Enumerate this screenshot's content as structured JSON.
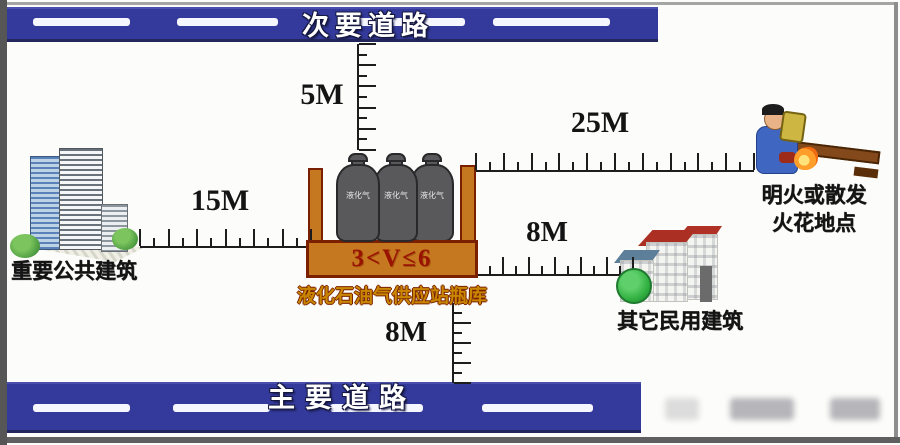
{
  "figure": {
    "secondary_road_label": "次要道路",
    "main_road_label": "主要道路",
    "dist_secondary_road": "5M",
    "dist_public_building": "15M",
    "dist_open_flame": "25M",
    "dist_civil_building": "8M",
    "dist_main_road": "8M",
    "volume_label": "3<V≤6",
    "station_caption": "液化石油气供应站瓶库",
    "cylinder_text": "液化气",
    "public_building_label": "重要公共建筑",
    "open_flame_label_line1": "明火或散发",
    "open_flame_label_line2": "火花地点",
    "civil_building_label": "其它民用建筑",
    "colors": {
      "road_blue": "#343a9b",
      "container_orange": "#c5781f",
      "container_border": "#7a2000",
      "volume_text": "#991300",
      "caption_gold": "#c98700"
    }
  }
}
